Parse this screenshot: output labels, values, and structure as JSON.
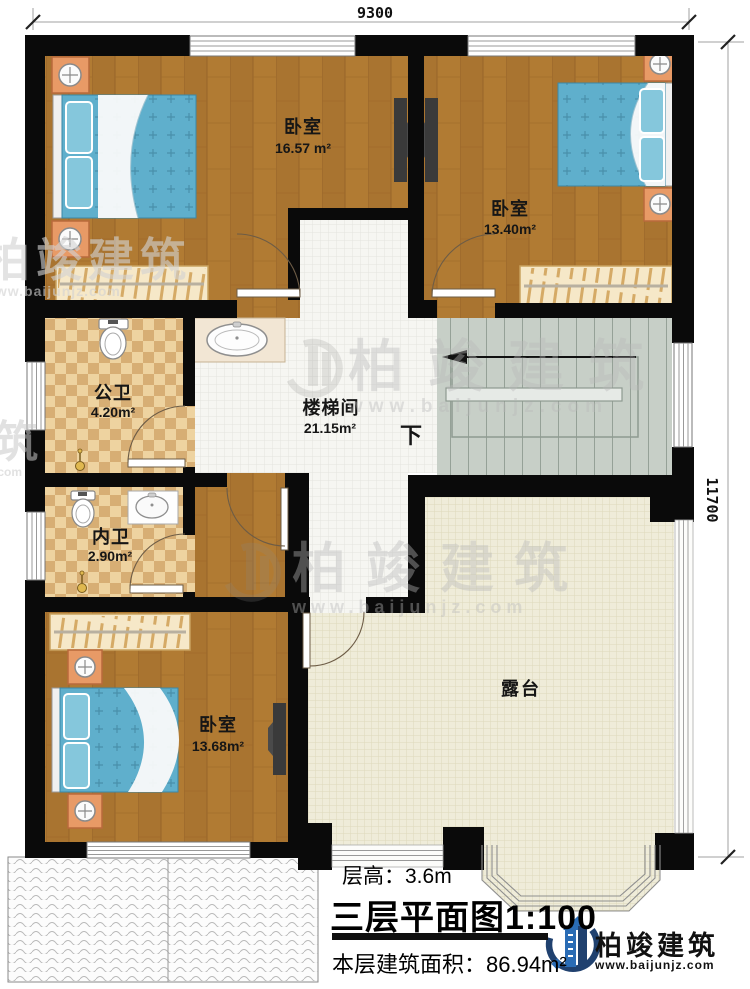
{
  "dimensions": {
    "top": "9300",
    "right": "11700"
  },
  "rooms": [
    {
      "name": "卧室",
      "area": "16.57 m²"
    },
    {
      "name": "卧室",
      "area": "13.40m²"
    },
    {
      "name": "公卫",
      "area": "4.20m²"
    },
    {
      "name": "楼梯间",
      "area": "21.15m²"
    },
    {
      "name": "内卫",
      "area": "2.90m²"
    },
    {
      "name": "卧室",
      "area": "13.68m²"
    },
    {
      "name": "露台",
      "area": ""
    }
  ],
  "stairs": {
    "down_label": "下"
  },
  "title_block": {
    "floor_height": "层高：3.6m",
    "plan_title": "三层平面图",
    "scale": "1:100",
    "floor_area": "本层建筑面积：86.94m²"
  },
  "brand": {
    "name": "柏竣建筑",
    "website": "www.baijunjz.com"
  },
  "watermark": {
    "name": "柏竣建筑",
    "website": "www.baijunjz.com",
    "partial_name": "筑",
    "partial_site": ".com"
  },
  "colors": {
    "wall": "#0a0a0a",
    "wood": "#b17b33",
    "bath_light": "#eed3a0",
    "bath_dark": "#d7ae74",
    "hall_tile": "#f6f6f2",
    "terrace": "#efecd9",
    "stairs": "#c7cfc7",
    "bed": "#5fafcc",
    "nightstand": "#e89a66",
    "logo_blue": "#2a6cb5",
    "logo_navy": "#20416f"
  }
}
